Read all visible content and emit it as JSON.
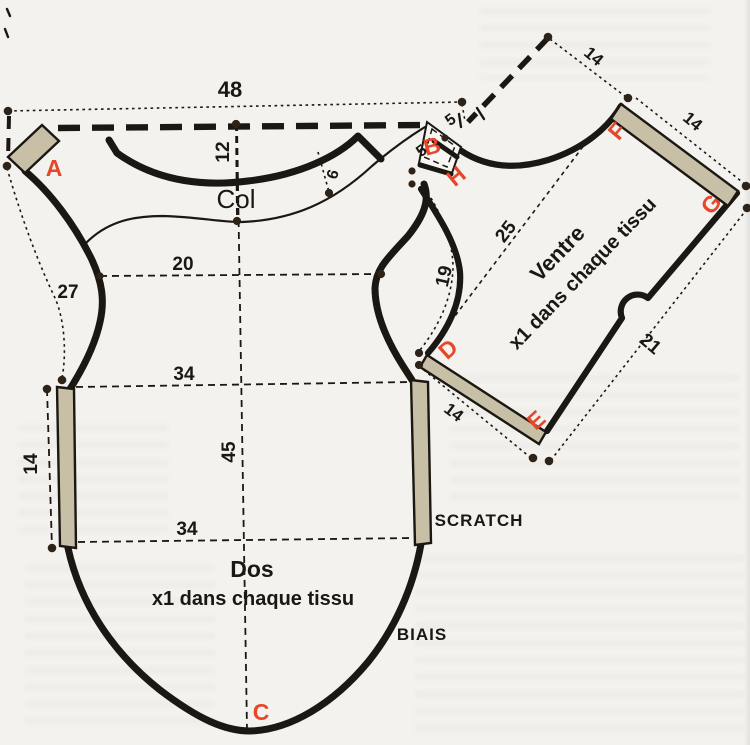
{
  "labels": {
    "col": "Col",
    "dos": "Dos",
    "dos_qty": "x1 dans chaque tissu",
    "ventre": "Ventre",
    "ventre_qty": "x1 dans chaque tissu",
    "scratch": "SCRATCH",
    "biais": "BIAIS"
  },
  "points": {
    "a": "A",
    "b": "B",
    "c": "C",
    "d": "D",
    "e": "E",
    "f": "F",
    "g": "G",
    "h": "H"
  },
  "dims": {
    "d48": "48",
    "d12": "12",
    "d6": "6",
    "d20": "20",
    "d27": "27",
    "d34_top": "34",
    "d34_bottom": "34",
    "d45": "45",
    "d14_left": "14",
    "d5_top": "5",
    "d5_side": "5",
    "d14_apex": "14",
    "d14_front": "14",
    "d25": "25",
    "d19": "19",
    "d21": "21",
    "d14_back": "14"
  },
  "colors": {
    "paper": "#f3f2ee",
    "ink": "#1b1712",
    "red": "#e5472b",
    "strip": "#c8bfa7",
    "dot": "#2e2318"
  }
}
